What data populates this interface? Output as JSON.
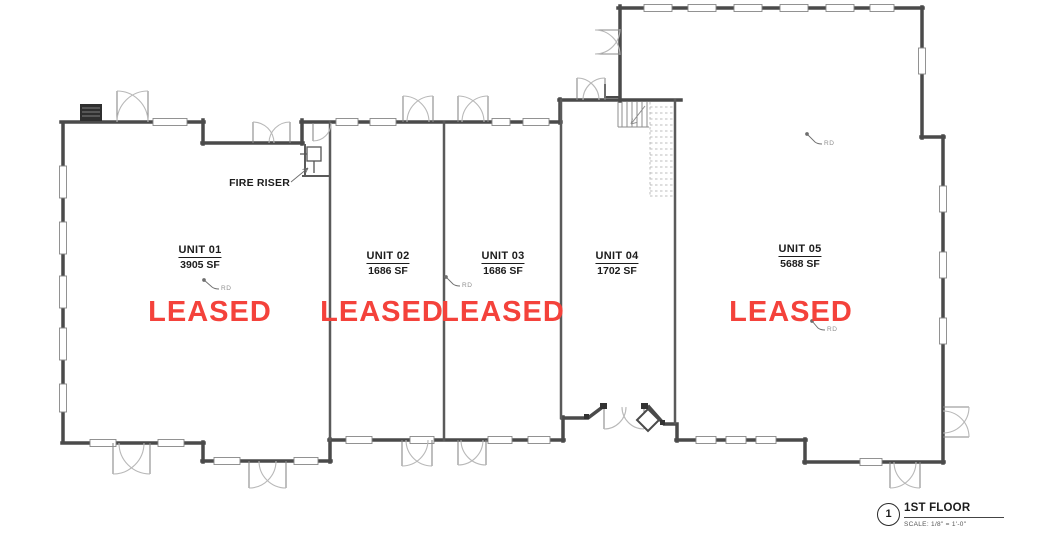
{
  "drawing": {
    "sheet_number": "1",
    "title": "1ST FLOOR",
    "scale_label": "SCALE:  1/8\" = 1'-0\"",
    "leased_color": "#f4423b",
    "line_color": "#4a4a4a"
  },
  "units": [
    {
      "name": "UNIT 01",
      "area": "3905 SF",
      "status": "LEASED"
    },
    {
      "name": "UNIT 02",
      "area": "1686 SF",
      "status": "LEASED"
    },
    {
      "name": "UNIT 03",
      "area": "1686 SF",
      "status": "LEASED"
    },
    {
      "name": "UNIT 04",
      "area": "1702 SF",
      "status": ""
    },
    {
      "name": "UNIT 05",
      "area": "5688 SF",
      "status": "LEASED"
    }
  ],
  "annotations": {
    "fire_riser_label": "FIRE RISER",
    "roof_drain_label": "RD"
  }
}
